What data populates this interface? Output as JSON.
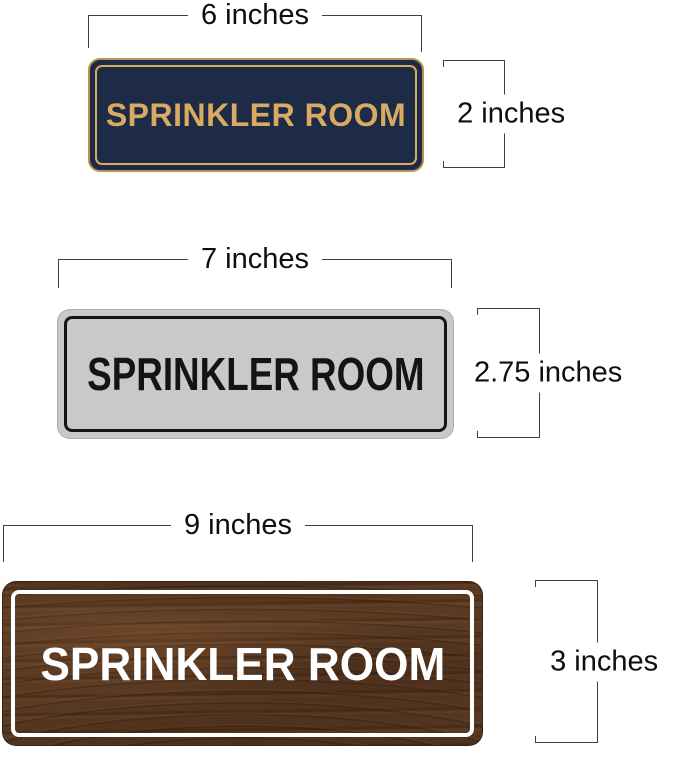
{
  "diagram": {
    "dimension_line_color": "#3f3f3f",
    "background_color": "#ffffff"
  },
  "signs": [
    {
      "name": "navy-gold-sign",
      "label": "SPRINKLER ROOM",
      "width_label": "6 inches",
      "height_label": "2 inches",
      "colors": {
        "background": "#1d2b47",
        "text": "#d9ab61",
        "border": "#d9ab61"
      }
    },
    {
      "name": "silver-black-sign",
      "label": "SPRINKLER ROOM",
      "width_label": "7 inches",
      "height_label": "2.75 inches",
      "colors": {
        "background": "#c9c9c9",
        "text": "#141414",
        "border": "#141414"
      }
    },
    {
      "name": "walnut-wood-sign",
      "label": "SPRINKLER ROOM",
      "width_label": "9 inches",
      "height_label": "3 inches",
      "colors": {
        "background": "#5a3a22",
        "text": "#ffffff",
        "border": "#ffffff"
      }
    }
  ]
}
